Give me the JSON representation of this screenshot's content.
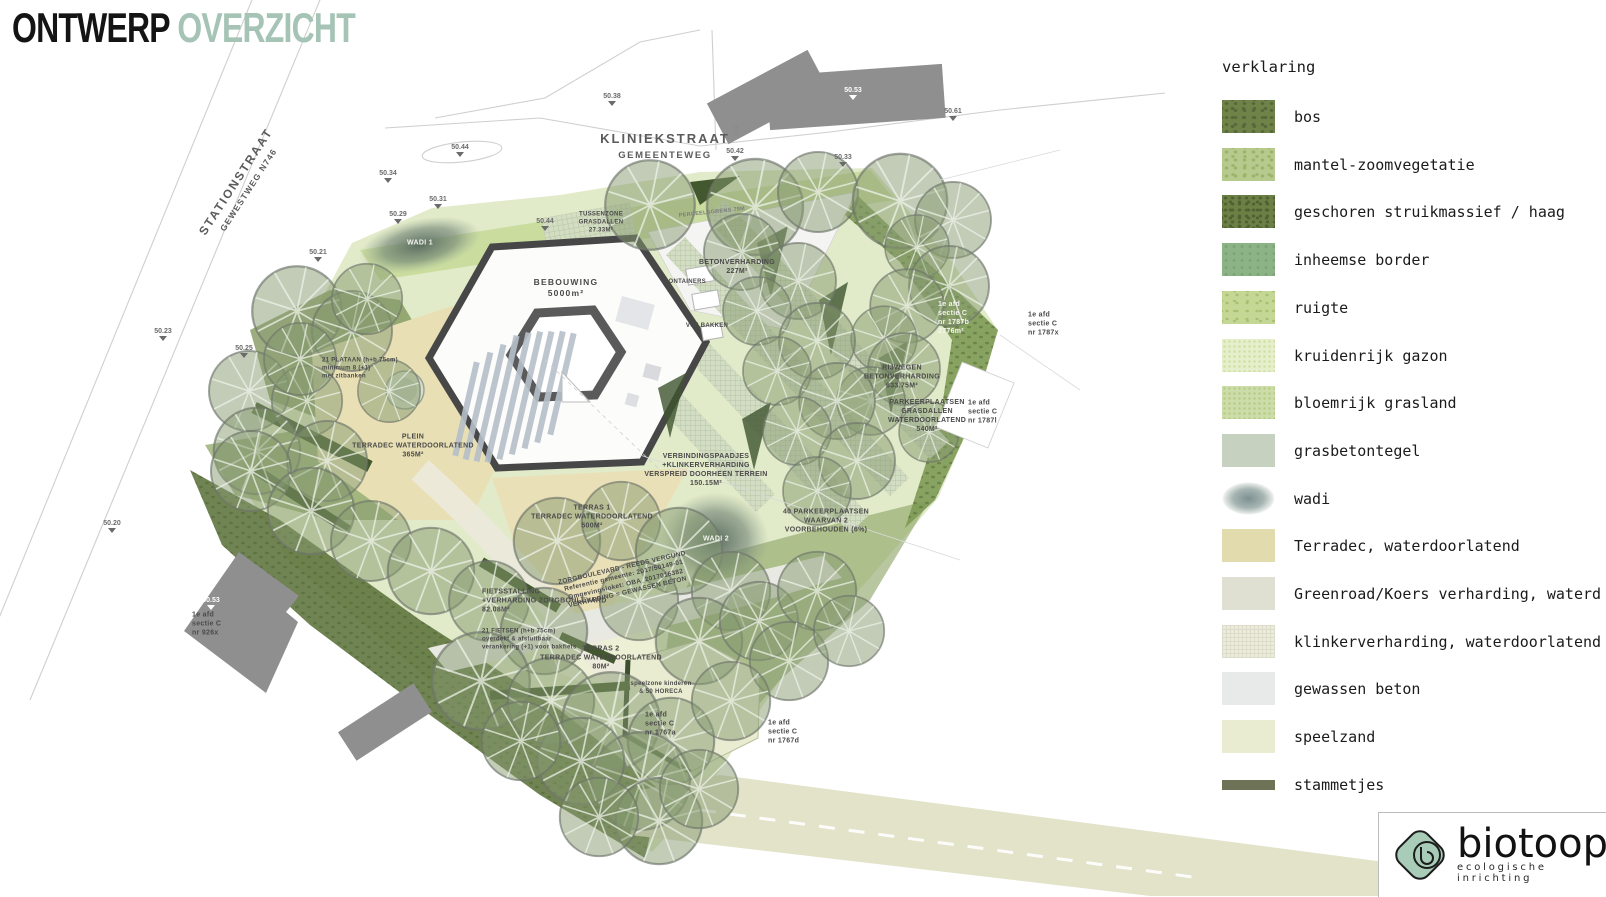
{
  "title": {
    "black": "ONTWERP",
    "accent": "OVERZICHT"
  },
  "legend": {
    "heading": "verklaring",
    "items": [
      {
        "label": "bos",
        "color": "#6f8349"
      },
      {
        "label": "mantel-zoomvegetatie",
        "color": "#b7ca8e"
      },
      {
        "label": "geschoren struikmassief / haag",
        "color": "#6c8045"
      },
      {
        "label": "inheemse border",
        "color": "#8cb386"
      },
      {
        "label": "ruigte",
        "color": "#c5d795"
      },
      {
        "label": "kruidenrijk gazon",
        "color": "#e6efcb"
      },
      {
        "label": "bloemrijk grasland",
        "color": "#cdddaa"
      },
      {
        "label": "grasbetontegel",
        "color": "#c7d1c0"
      },
      {
        "label": "wadi",
        "color": "#88999b"
      },
      {
        "label": "Terradec, waterdoorlatend",
        "color": "#e2dbae"
      },
      {
        "label": "Greenroad/Koers verharding, waterd",
        "color": "#dfe0d1"
      },
      {
        "label": "klinkerverharding, waterdoorlatend",
        "color": "#ecebdc"
      },
      {
        "label": "gewassen beton",
        "color": "#e8eae9"
      },
      {
        "label": "speelzand",
        "color": "#e9ecd0"
      },
      {
        "label": "stammetjes",
        "color": "#6e7257"
      }
    ]
  },
  "map": {
    "streets": {
      "kliniekstraat": "KLINIEKSTRAAT",
      "kliniekstraat_type": "GEMEENTEWEG",
      "stationstraat": "STATIONSTRAAT",
      "stationstraat_type": "GEWESTWEG N746"
    },
    "labels": [
      {
        "text": "BEBOUWING\n5000m²"
      },
      {
        "text": "CONTAINERS"
      },
      {
        "text": "VUILBAKKEN"
      },
      {
        "text": "BETONVERHARDING\n227M²"
      },
      {
        "text": "TUSSENZONE\nGRASDALLEN\n27.33M²"
      },
      {
        "text": "RIJWEGEN\nBETONVERHARDING\n633.75M²"
      },
      {
        "text": "PARKEERPLAATSEN\nGRASDALLEN\nWATERDOORLATEND\n540M²"
      },
      {
        "text": "40 PARKEERPLAATSEN\nWAARVAN 2\nVOORBEHOUDEN (6%)"
      },
      {
        "text": "VERBINDINGSPAADJES\n+KLINKERVERHARDING\nVERSPREID DOORHEEN TERREIN\n150.15M²"
      },
      {
        "text": "PLEIN\nTERRADEC WATERDOORLATEND\n365M²"
      },
      {
        "text": "TERRAS 1\nTERRADEC WATERDOORLATEND\n500M²"
      },
      {
        "text": "TERRAS 2\nTERRADEC WATERDOORLATEND\n80M²"
      },
      {
        "text": "FIETSSTALLING\n+VERHARDING ZORGBOULEVARD\n82.08M²"
      },
      {
        "text": "21 FIETSEN (h+b 75cm)\noverdekt & afsluitbaar\nverankering (+1) voor bakfiets"
      },
      {
        "text": "21 PLATAAN (h+b 75cm)\nminimum 8 (+1)\nmet zitbanken"
      },
      {
        "text": "WADI 1"
      },
      {
        "text": "WADI 2"
      },
      {
        "text": "speelzone kinderen\n& 50 HORECA"
      },
      {
        "text": "ZORGBOULEVARD - REEDS VERGUND\nReferentie gemeente: 2017/50149-01\nOmgevingsloket: OBA_2017016382\nVERHARDING = GEWASSEN BETON"
      },
      {
        "text": "1e afd\nsectie C\nnr 1787b\n2776m²"
      },
      {
        "text": "1e afd\nsectie C\nnr 1787x"
      },
      {
        "text": "1e afd\nsectie C\nnr 1787l"
      },
      {
        "text": "1e afd\nsectie C\nnr 1767a"
      },
      {
        "text": "1e afd\nsectie C\nnr 1767d"
      },
      {
        "text": "1e afd\nsectie C\nnr 926x"
      },
      {
        "text": "PERCEELSGRENS 79M"
      },
      {
        "text": "607"
      }
    ],
    "markers": [
      {
        "value": "50.38"
      },
      {
        "value": "50.42"
      },
      {
        "value": "50.53"
      },
      {
        "value": "50.61"
      },
      {
        "value": "50.33"
      },
      {
        "value": "50.44"
      },
      {
        "value": "50.34"
      },
      {
        "value": "50.31"
      },
      {
        "value": "50.29"
      },
      {
        "value": "50.44"
      },
      {
        "value": "50.21"
      },
      {
        "value": "50.23"
      },
      {
        "value": "50.25"
      },
      {
        "value": "50.20"
      },
      {
        "value": "50.53"
      }
    ]
  },
  "logo": {
    "name": "biotoop",
    "tagline": "ecologische inrichting"
  }
}
